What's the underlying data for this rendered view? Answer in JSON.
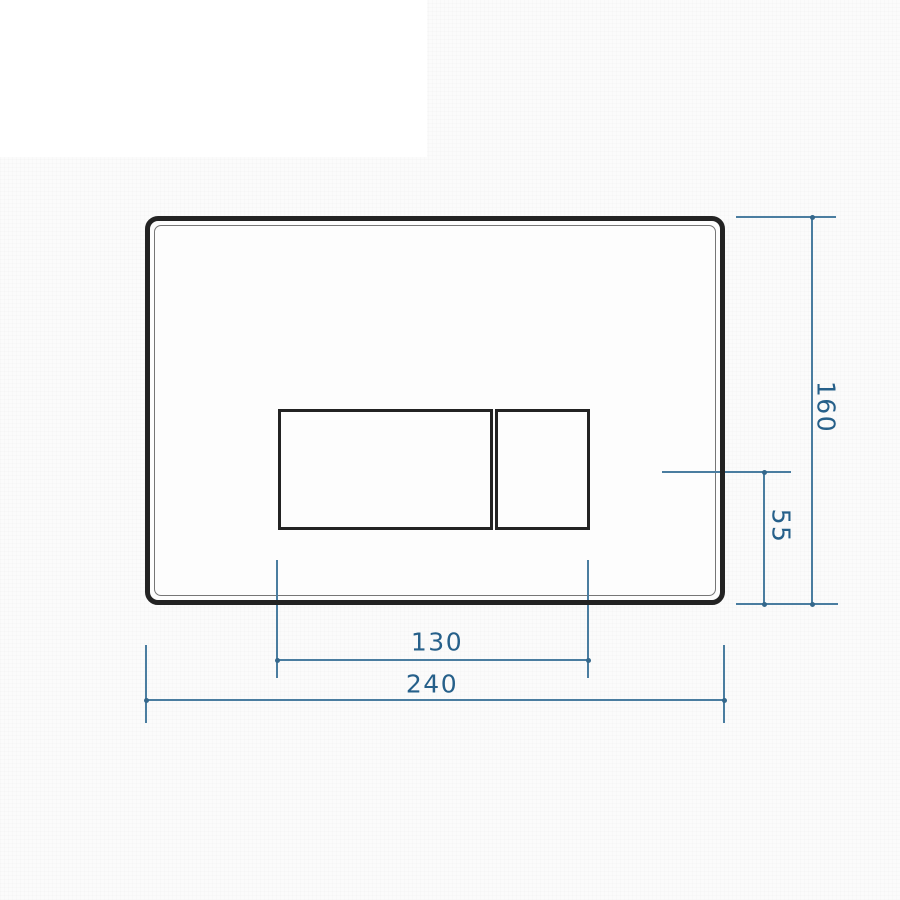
{
  "title": "Flush plate dimensional drawing",
  "colors": {
    "canvas-bg": "#fbfbfb",
    "plate-face": "#fdfdfd",
    "outline": "#232323",
    "dim-line": "#4a7da0",
    "dim-dot": "#35688c",
    "dim-text": "#26608a"
  },
  "dimensions": {
    "plate_width": {
      "value": "240"
    },
    "plate_height": {
      "value": "160"
    },
    "buttons_width": {
      "value": "130"
    },
    "button_axis_to_bottom": {
      "value": "55"
    }
  }
}
